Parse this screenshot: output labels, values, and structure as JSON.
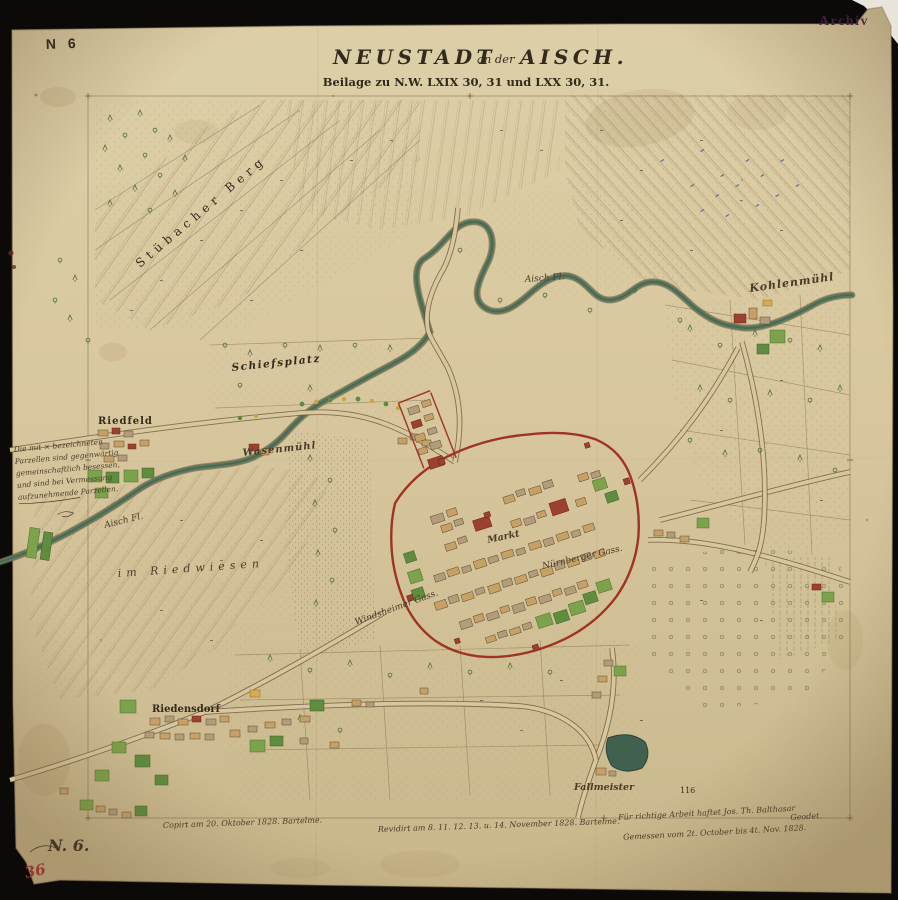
{
  "frame": {
    "stamp_n6": "N 6",
    "stamp_archiv": "Archiv",
    "sheet_no": "N. 6.",
    "red_no": "36"
  },
  "title": {
    "part1": "NEUSTADT",
    "part2": "an der",
    "part3": "AISCH.",
    "subtitle": "Beilage zu N.W. LXIX 30, 31 und LXX 30, 31."
  },
  "labels": {
    "stuebacher_berg": "Stübacher Berg",
    "schiessplatz": "Schiefsplatz",
    "riedfeld": "Riedfeld",
    "wasenmuehl": "Wasenmühl",
    "aisch_fl_upper": "Aisch Fl.",
    "aisch_fl_lower": "Aisch Fl.",
    "kohlenmuehl": "Kohlenmühl",
    "riedwiesen": "im Riedwiesen",
    "markt": "Markt",
    "nuernberger_gasse": "Nürnberger Gass.",
    "windsheimer_gasse": "Windsheimer Gass.",
    "riedensdorf": "Riedensdorf",
    "fallmeister": "Fallmeister",
    "parcel_116": "116"
  },
  "margin_note": {
    "l1": "Die mit × bezeichneten",
    "l2": "Parzellen sind gegenwärtig",
    "l3": "gemeinschaftlich besessen,",
    "l4": "und sind bei Vermessung",
    "l5": "aufzunehmende Parzellen."
  },
  "notes": {
    "copied": "Copirt am 20. Oktober 1828. Bartelme.",
    "revised": "Revidirt am 8. 11. 12. 13. u. 14. November 1828. Bartelme.",
    "liability1": "Für richtige Arbeit haftet Jos. Th. Balthasar",
    "liability2": "Geodet.",
    "measured": "Gemessen vom 2t. October bis 4t. Nov. 1828."
  },
  "colors": {
    "paper": "#d8c79e",
    "river": "#5d7a5f",
    "town_red": "#9c4030",
    "garden_green": "#7da24c",
    "wall_red": "#9e3423",
    "ink": "#332a1d",
    "blue_numbers": "#3f6396",
    "archiv_stamp": "#3f2138",
    "red_number": "#b02a35"
  }
}
